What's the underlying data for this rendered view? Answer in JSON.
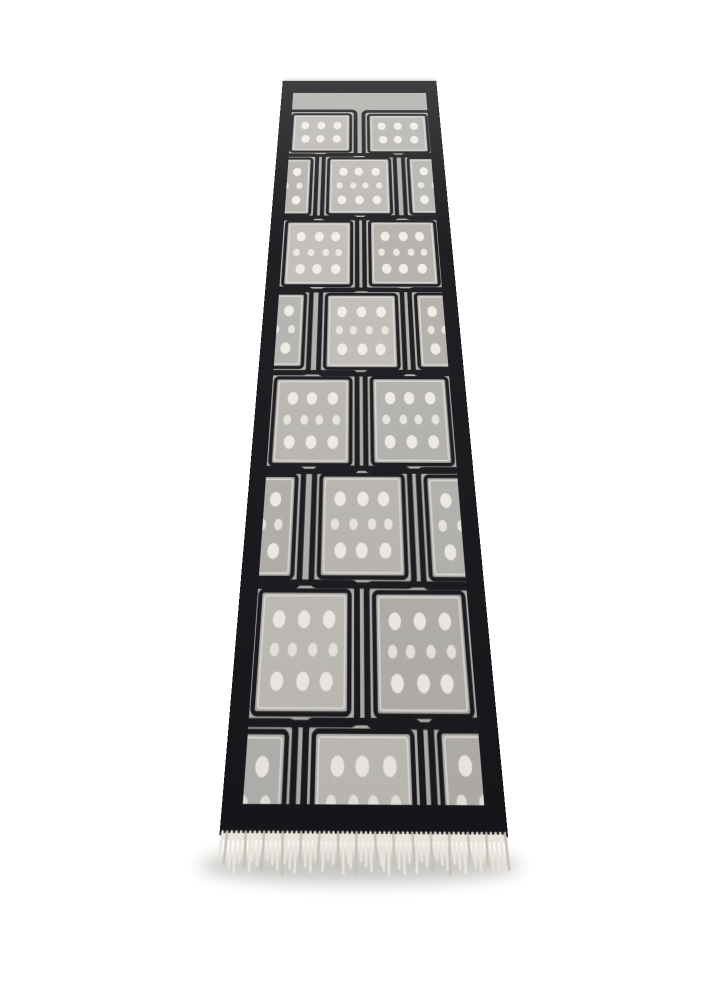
{
  "scene": {
    "type": "product-photograph",
    "subject": "Black and grey hand-tufted geometric runner rug with a squares-and-dots pattern, photographed flat in perspective receding toward the top, cream fringe at the near end",
    "background_color": "#ffffff"
  },
  "rug": {
    "colors": {
      "field_black": "#1a1a1e",
      "border_black": "#17171b",
      "ground_grey": "#b1afab",
      "square_greys": [
        "#bcb9b5",
        "#b6b4b0",
        "#c1beb9",
        "#b4b1ad"
      ],
      "square_outline": "#dedbd5",
      "frame_hairline_grey": "#9d9b97",
      "dot_white": "#f1eee8",
      "dot_small": "#eae7e1",
      "selvage_white": "#f2efe8",
      "fringe_cream": "#e8e4da",
      "fringe_shadow": "#c6c0b3",
      "floor_shadow": "rgba(45,42,38,0.30)"
    },
    "pattern": {
      "motif": "staggered grid of dotted grey squares linked by concentric black line frames on a grey ground",
      "row_count": 8,
      "row_types": [
        "full",
        "offset",
        "full",
        "offset",
        "full",
        "offset",
        "full",
        "offset"
      ],
      "squares_per_full_row": 2,
      "dot_rows_per_square": [
        3,
        4,
        3
      ],
      "top_row_dot_rows": [
        3,
        3
      ],
      "dot_shape": "oval",
      "bottom_row_clipped_by_border": true
    },
    "fringe": {
      "position": "bottom",
      "tassel_count": 62
    },
    "perspective": {
      "top_edge_width_px": 153,
      "bottom_edge_width_px": 296,
      "on_screen_length_px": 800
    }
  }
}
